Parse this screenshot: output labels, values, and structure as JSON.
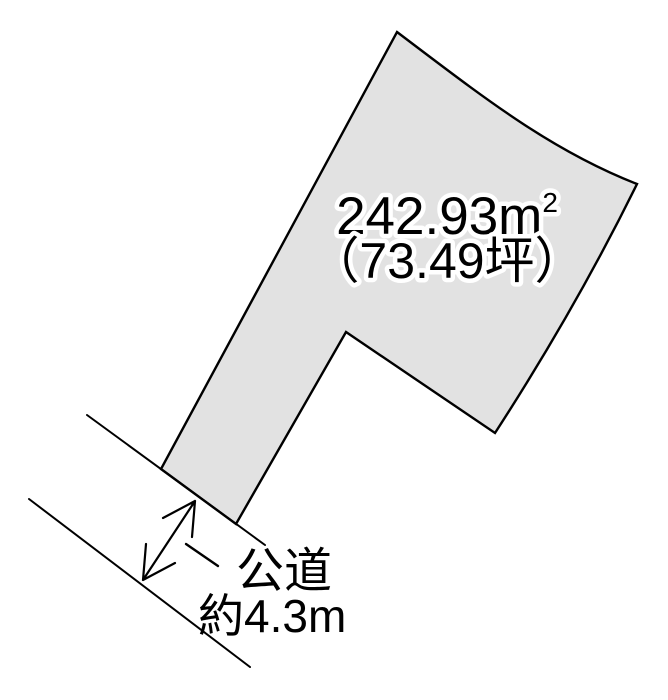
{
  "diagram": {
    "kind": "real-estate-land-plot-diagram",
    "background_color": "#ffffff",
    "line_color": "#000000"
  },
  "parcel": {
    "fill_color": "#e2e2e2",
    "area_label": {
      "value": "242.93m",
      "superscript": "2",
      "tsubo": "（73.49坪）"
    }
  },
  "road": {
    "label": "公道",
    "width_label": "約4.3m"
  }
}
